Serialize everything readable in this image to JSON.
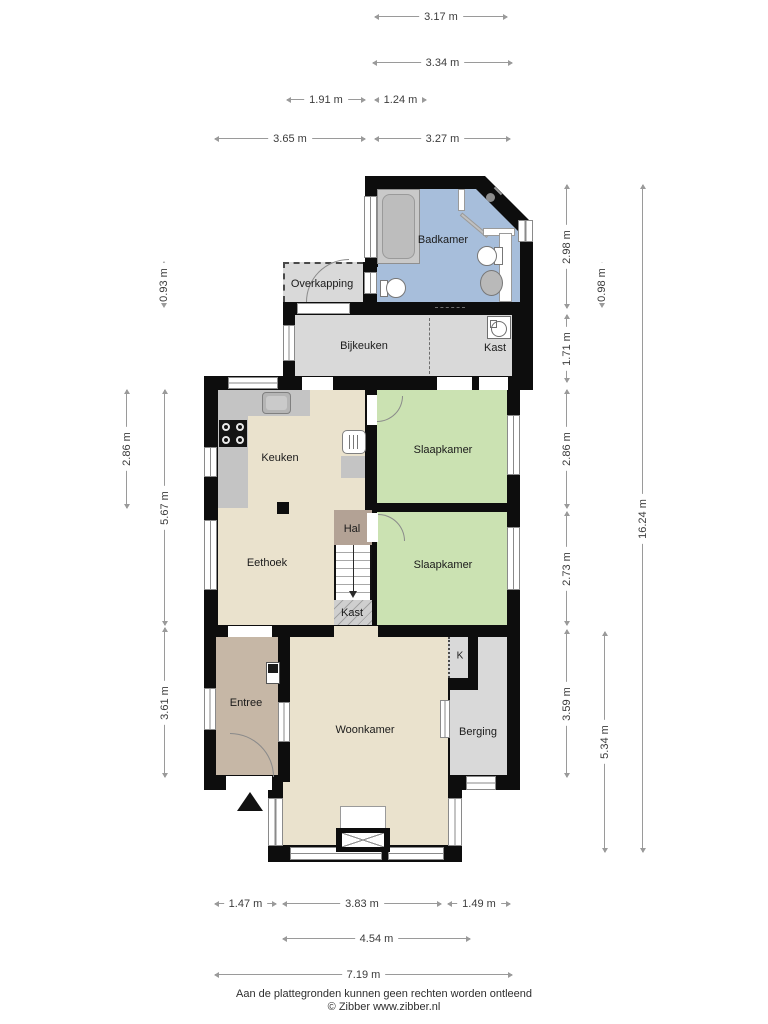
{
  "rooms": {
    "badkamer": "Badkamer",
    "overkapping": "Overkapping",
    "bijkeuken": "Bijkeuken",
    "kast_washing": "Kast",
    "keuken": "Keuken",
    "slaapkamer_1": "Slaapkamer",
    "hal": "Hal",
    "slaapkamer_2": "Slaapkamer",
    "eethoek": "Eethoek",
    "kast_stairs": "Kast",
    "entree": "Entree",
    "woonkamer": "Woonkamer",
    "k_closet": "K",
    "berging": "Berging"
  },
  "dimensions": {
    "top": {
      "d317": "3.17 m",
      "d334": "3.34 m",
      "d191": "1.91 m",
      "d124": "1.24 m",
      "d365": "3.65 m",
      "d327": "3.27 m"
    },
    "left": {
      "d093": "0.93 m",
      "d286": "2.86 m",
      "d567": "5.67 m",
      "d361": "3.61 m"
    },
    "right": {
      "d298": "2.98 m",
      "d098": "0.98 m",
      "d171": "1.71 m",
      "d286": "2.86 m",
      "d273": "2.73 m",
      "d359": "3.59 m",
      "d534": "5.34 m",
      "d1624": "16.24 m"
    },
    "bottom": {
      "d147": "1.47 m",
      "d383": "3.83 m",
      "d149": "1.49 m",
      "d454": "4.54 m",
      "d719": "7.19 m"
    }
  },
  "footer": {
    "disclaimer": "Aan de plattegronden kunnen geen rechten worden ontleend",
    "copyright": "© Zibber www.zibber.nl"
  },
  "colors": {
    "wall": "#0d0d0d",
    "bathroom_blue": "#a7bedb",
    "bedroom_green": "#cbe2b2",
    "living_beige": "#eae2cd",
    "utility_gray": "#d9d9d9",
    "hall_brown": "#b3a295",
    "entree_brown": "#c6b7a6"
  }
}
